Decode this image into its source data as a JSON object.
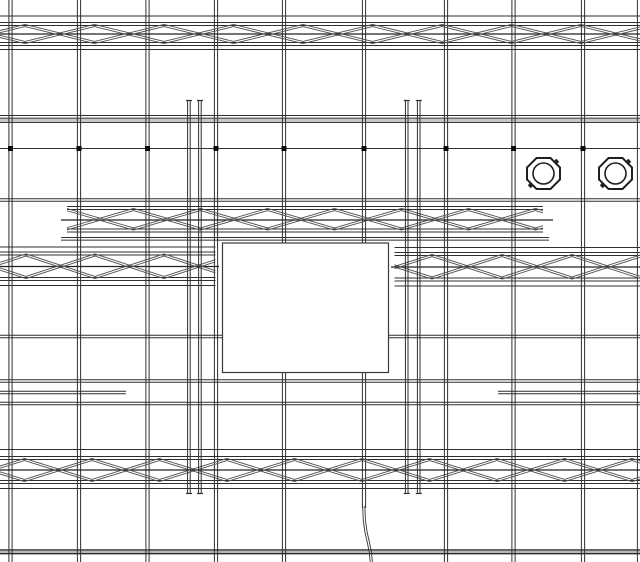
{
  "title": "structural-ceiling-plan-drawing",
  "canvas": {
    "width": 640,
    "height": 562,
    "background": "#ffffff"
  },
  "colors": {
    "line": "#2f2f2f",
    "line_soft": "#4a4a4a",
    "diagonal": "#4f4f4f",
    "band_fill": "#c6c6c6",
    "band_dark_fill": "#b5b5b5",
    "dot": "#0a0a0a",
    "symbol": "#1f1f1f",
    "rect_stroke": "#3a3a3a",
    "background": "#ffffff"
  },
  "grid": {
    "vertical_lines": [
      {
        "x": 10.5,
        "y1": 0,
        "y2": 562,
        "style": "double"
      },
      {
        "x": 79,
        "y1": 0,
        "y2": 562,
        "style": "double"
      },
      {
        "x": 147.5,
        "y1": 0,
        "y2": 562,
        "style": "double"
      },
      {
        "x": 216,
        "y1": 0,
        "y2": 562,
        "style": "double"
      },
      {
        "x": 284,
        "y1": 0,
        "y2": 562,
        "style": "double"
      },
      {
        "x": 364,
        "y1": 0,
        "y2": 508,
        "style": "double"
      },
      {
        "x": 446,
        "y1": 0,
        "y2": 562,
        "style": "double"
      },
      {
        "x": 513.5,
        "y1": 0,
        "y2": 562,
        "style": "double"
      },
      {
        "x": 583,
        "y1": 0,
        "y2": 562,
        "style": "double"
      },
      {
        "x": 639,
        "y1": 0,
        "y2": 562,
        "style": "double"
      }
    ],
    "horizontal_lines": [
      {
        "y": 16,
        "x1": 0,
        "x2": 640,
        "style": "single"
      },
      {
        "y": 49.5,
        "x1": 0,
        "x2": 640,
        "style": "single"
      },
      {
        "y": 115.5,
        "x1": 0,
        "x2": 640,
        "style": "single"
      },
      {
        "y": 120.3,
        "x1": 0,
        "x2": 640,
        "style": "band"
      },
      {
        "y": 200,
        "x1": 0,
        "x2": 640,
        "style": "double"
      },
      {
        "y": 336.5,
        "x1": 0,
        "x2": 640,
        "style": "double"
      },
      {
        "y": 381,
        "x1": 0,
        "x2": 640,
        "style": "double"
      },
      {
        "y": 392.5,
        "x1": 0,
        "x2": 126,
        "style": "double"
      },
      {
        "y": 392.5,
        "x1": 498,
        "x2": 640,
        "style": "double"
      },
      {
        "y": 403.5,
        "x1": 0,
        "x2": 640,
        "style": "double"
      },
      {
        "y": 551.8,
        "x1": 0,
        "x2": 640,
        "style": "band-dark"
      }
    ]
  },
  "reference_dot_line": {
    "y": 148.5,
    "x1": 0,
    "x2": 640,
    "dot_size": 5,
    "dot_xs": [
      10.5,
      79,
      147.5,
      216,
      284,
      364,
      446,
      513.5,
      583
    ]
  },
  "trusses": [
    {
      "id": "truss-top",
      "x1": 0,
      "x2": 640,
      "top_chord": [
        22.5,
        25.5
      ],
      "bottom_chord": [
        42.5,
        45.5
      ],
      "center_line": {
        "y": 34,
        "x1": 0,
        "x2": 640
      },
      "outer_lines": [],
      "panel_x0": -44.5,
      "panel_width": 69.5
    },
    {
      "id": "truss-middle",
      "x1": 67,
      "x2": 543,
      "top_chord": [
        206.5,
        209.5
      ],
      "bottom_chord": [
        229,
        232
      ],
      "center_line": {
        "y": 220,
        "x1": 61,
        "x2": 553
      },
      "outer_lines": [
        {
          "y": 238.8,
          "x1": 61,
          "x2": 549,
          "style": "double"
        }
      ],
      "panel_x0": 66.5,
      "panel_width": 67
    },
    {
      "id": "truss-row2-left",
      "x1": 0,
      "x2": 215.5,
      "top_chord": [
        252,
        255
      ],
      "bottom_chord": [
        277.5,
        280.5
      ],
      "center_line": {
        "y": 266.5,
        "x1": 0,
        "x2": 219
      },
      "outer_lines": [
        {
          "y": 247,
          "x1": 0,
          "x2": 215.5,
          "style": "single"
        },
        {
          "y": 285.5,
          "x1": 0,
          "x2": 215.5,
          "style": "single"
        }
      ],
      "panel_x0": -43,
      "panel_width": 69
    },
    {
      "id": "truss-row2-right",
      "x1": 394.5,
      "x2": 640,
      "top_chord": [
        252.5,
        255.5
      ],
      "bottom_chord": [
        278,
        281
      ],
      "center_line": {
        "y": 267,
        "x1": 391,
        "x2": 640
      },
      "outer_lines": [
        {
          "y": 247.5,
          "x1": 394.5,
          "x2": 640,
          "style": "single"
        },
        {
          "y": 286,
          "x1": 394.5,
          "x2": 640,
          "style": "single"
        }
      ],
      "panel_x0": 362,
      "panel_width": 70
    },
    {
      "id": "truss-bottom",
      "x1": 0,
      "x2": 640,
      "top_chord": [
        456.5,
        459.5
      ],
      "bottom_chord": [
        480.5,
        483.5
      ],
      "center_line": {
        "y": 470,
        "x1": 0,
        "x2": 640
      },
      "outer_lines": [
        {
          "y": 449.5,
          "x1": 0,
          "x2": 640,
          "style": "single"
        },
        {
          "y": 488.5,
          "x1": 0,
          "x2": 640,
          "style": "single"
        }
      ],
      "panel_x0": -43,
      "panel_width": 67.5
    }
  ],
  "tall_line_pairs": [
    {
      "id": "hanger-pair-left",
      "xs": [
        187.6,
        190.2,
        198.6,
        201.2
      ],
      "y1": 100.5,
      "y2": 493.5,
      "tick_spans": [
        [
          186,
          192
        ],
        [
          197,
          203
        ]
      ]
    },
    {
      "id": "hanger-pair-right",
      "xs": [
        405.4,
        408,
        417.4,
        420
      ],
      "y1": 100.5,
      "y2": 493.5,
      "tick_spans": [
        [
          403.8,
          409.8
        ],
        [
          415.8,
          421.8
        ]
      ]
    }
  ],
  "octagon_symbols": {
    "width": 33,
    "height": 31,
    "corner_cut": 9.5,
    "circle_radius": 10.5,
    "items": [
      {
        "id": "octagon-fixture-1",
        "cx": 543.5,
        "cy": 173.5
      },
      {
        "id": "octagon-fixture-2",
        "cx": 615.5,
        "cy": 173.5
      }
    ]
  },
  "white_rectangle": {
    "x": 222.5,
    "y": 243,
    "w": 166,
    "h": 129.5
  },
  "curve": {
    "points": [
      [
        363.8,
        506
      ],
      [
        364.3,
        520
      ],
      [
        366,
        532
      ],
      [
        368.5,
        543
      ],
      [
        370.3,
        552
      ],
      [
        371.3,
        562
      ]
    ]
  }
}
